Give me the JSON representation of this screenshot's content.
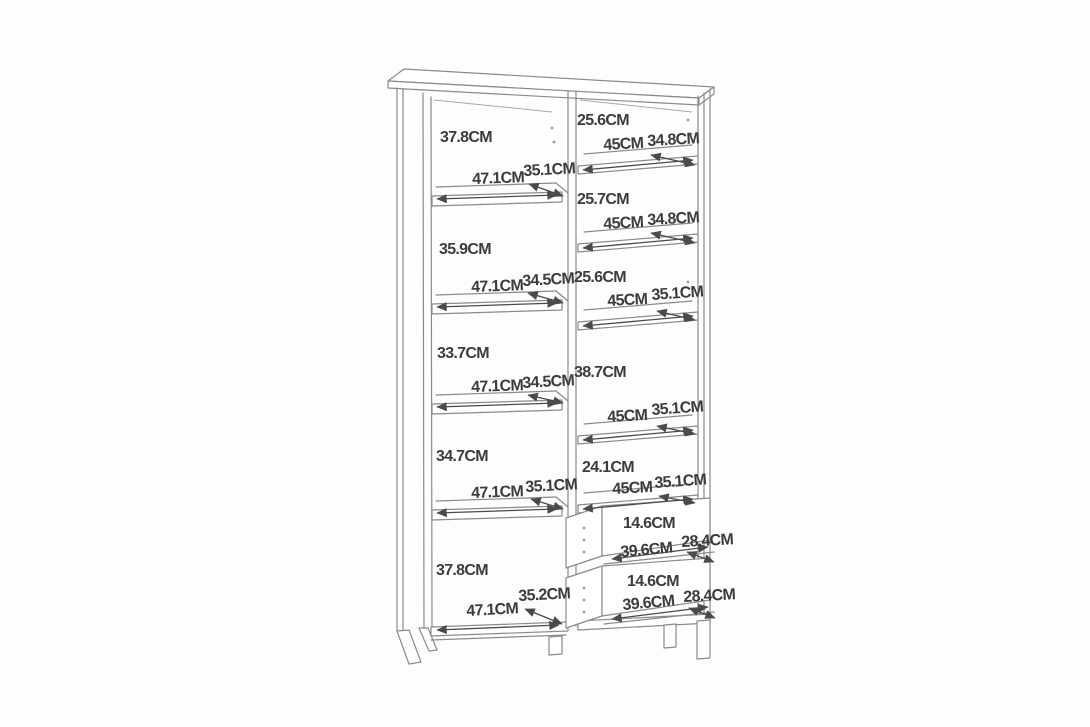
{
  "page": {
    "background": "#fdfdfd"
  },
  "drawing": {
    "type": "furniture-dimension-diagram",
    "subject": "tall open cabinet with two columns of shelves and two drawers, shown in perspective line-art",
    "unit": "CM",
    "line_color": "#8a8a8a",
    "arrow_color": "#4a4a4a",
    "text_color": "#3c3c3c",
    "left_column_compartments": [
      {
        "height": "37.8CM",
        "width": "47.1CM",
        "depth": "35.1CM"
      },
      {
        "height": "35.9CM",
        "width": "47.1CM",
        "depth": "34.5CM"
      },
      {
        "height": "33.7CM",
        "width": "47.1CM",
        "depth": "34.5CM"
      },
      {
        "height": "34.7CM",
        "width": "47.1CM",
        "depth": "35.1CM"
      },
      {
        "height": "37.8CM",
        "width": "47.1CM",
        "depth": "35.2CM"
      }
    ],
    "right_column_compartments": [
      {
        "height": "25.6CM",
        "width": "45CM",
        "depth": "34.8CM"
      },
      {
        "height": "25.7CM",
        "width": "45CM",
        "depth": "34.8CM"
      },
      {
        "height": "25.6CM",
        "width": "45CM",
        "depth": "35.1CM"
      },
      {
        "height": "38.7CM",
        "width": "45CM",
        "depth": "35.1CM"
      },
      {
        "height": "24.1CM",
        "width": "45CM",
        "depth": "35.1CM"
      }
    ],
    "drawers": [
      {
        "height": "14.6CM",
        "width": "39.6CM",
        "depth": "28.4CM"
      },
      {
        "height": "14.6CM",
        "width": "39.6CM",
        "depth": "28.4CM"
      }
    ]
  },
  "annotations": [
    {
      "name": "left-comp1-height",
      "t": "37.8CM",
      "x": 440,
      "y": 130,
      "rot": 0
    },
    {
      "name": "left-comp2-height",
      "t": "35.9CM",
      "x": 439,
      "y": 242,
      "rot": 0
    },
    {
      "name": "left-comp3-height",
      "t": "33.7CM",
      "x": 437,
      "y": 346,
      "rot": 0
    },
    {
      "name": "left-comp4-height",
      "t": "34.7CM",
      "x": 436,
      "y": 449,
      "rot": 0
    },
    {
      "name": "left-comp5-height",
      "t": "37.8CM",
      "x": 436,
      "y": 563,
      "rot": 0
    },
    {
      "name": "left-comp1-width",
      "t": "47.1CM",
      "x": 472,
      "y": 172,
      "rot": -2
    },
    {
      "name": "left-comp2-width",
      "t": "47.1CM",
      "x": 471,
      "y": 280,
      "rot": -2
    },
    {
      "name": "left-comp3-width",
      "t": "47.1CM",
      "x": 471,
      "y": 380,
      "rot": -2
    },
    {
      "name": "left-comp4-width",
      "t": "47.1CM",
      "x": 471,
      "y": 486,
      "rot": -2
    },
    {
      "name": "left-comp5-width",
      "t": "47.1CM",
      "x": 466,
      "y": 604,
      "rot": -3
    },
    {
      "name": "left-comp1-depth",
      "t": "35.1CM",
      "x": 523,
      "y": 164,
      "rot": -3
    },
    {
      "name": "left-comp2-depth",
      "t": "34.5CM",
      "x": 522,
      "y": 274,
      "rot": -3
    },
    {
      "name": "left-comp3-depth",
      "t": "34.5CM",
      "x": 522,
      "y": 376,
      "rot": -3
    },
    {
      "name": "left-comp4-depth",
      "t": "35.1CM",
      "x": 525,
      "y": 480,
      "rot": -3
    },
    {
      "name": "left-comp5-depth",
      "t": "35.2CM",
      "x": 518,
      "y": 589,
      "rot": -3
    },
    {
      "name": "right-comp1-height",
      "t": "25.6CM",
      "x": 577,
      "y": 113,
      "rot": 0
    },
    {
      "name": "right-comp2-height",
      "t": "25.7CM",
      "x": 577,
      "y": 192,
      "rot": 0
    },
    {
      "name": "right-comp3-height",
      "t": "25.6CM",
      "x": 574,
      "y": 270,
      "rot": 0
    },
    {
      "name": "right-comp4-height",
      "t": "38.7CM",
      "x": 574,
      "y": 365,
      "rot": 0
    },
    {
      "name": "right-comp5-height",
      "t": "24.1CM",
      "x": 582,
      "y": 460,
      "rot": 0
    },
    {
      "name": "right-comp1-width",
      "t": "45CM",
      "x": 603,
      "y": 138,
      "rot": -3
    },
    {
      "name": "right-comp2-width",
      "t": "45CM",
      "x": 603,
      "y": 217,
      "rot": -3
    },
    {
      "name": "right-comp3-width",
      "t": "45CM",
      "x": 607,
      "y": 294,
      "rot": -3
    },
    {
      "name": "right-comp4-width",
      "t": "45CM",
      "x": 607,
      "y": 410,
      "rot": -3
    },
    {
      "name": "right-comp5-width",
      "t": "45CM",
      "x": 612,
      "y": 482,
      "rot": -3
    },
    {
      "name": "right-comp1-depth",
      "t": "34.8CM",
      "x": 647,
      "y": 134,
      "rot": -3
    },
    {
      "name": "right-comp2-depth",
      "t": "34.8CM",
      "x": 647,
      "y": 213,
      "rot": -3
    },
    {
      "name": "right-comp3-depth",
      "t": "35.1CM",
      "x": 651,
      "y": 288,
      "rot": -4
    },
    {
      "name": "right-comp4-depth",
      "t": "35.1CM",
      "x": 651,
      "y": 403,
      "rot": -4
    },
    {
      "name": "right-comp5-depth",
      "t": "35.1CM",
      "x": 654,
      "y": 476,
      "rot": -4
    },
    {
      "name": "drawer1-height",
      "t": "14.6CM",
      "x": 623,
      "y": 516,
      "rot": 0
    },
    {
      "name": "drawer1-width",
      "t": "39.6CM",
      "x": 620,
      "y": 545,
      "rot": -5
    },
    {
      "name": "drawer1-depth",
      "t": "28.4CM",
      "x": 681,
      "y": 535,
      "rot": -3
    },
    {
      "name": "drawer2-height",
      "t": "14.6CM",
      "x": 627,
      "y": 574,
      "rot": 0
    },
    {
      "name": "drawer2-width",
      "t": "39.6CM",
      "x": 622,
      "y": 598,
      "rot": -5
    },
    {
      "name": "drawer2-depth",
      "t": "28.4CM",
      "x": 683,
      "y": 590,
      "rot": -3
    }
  ]
}
